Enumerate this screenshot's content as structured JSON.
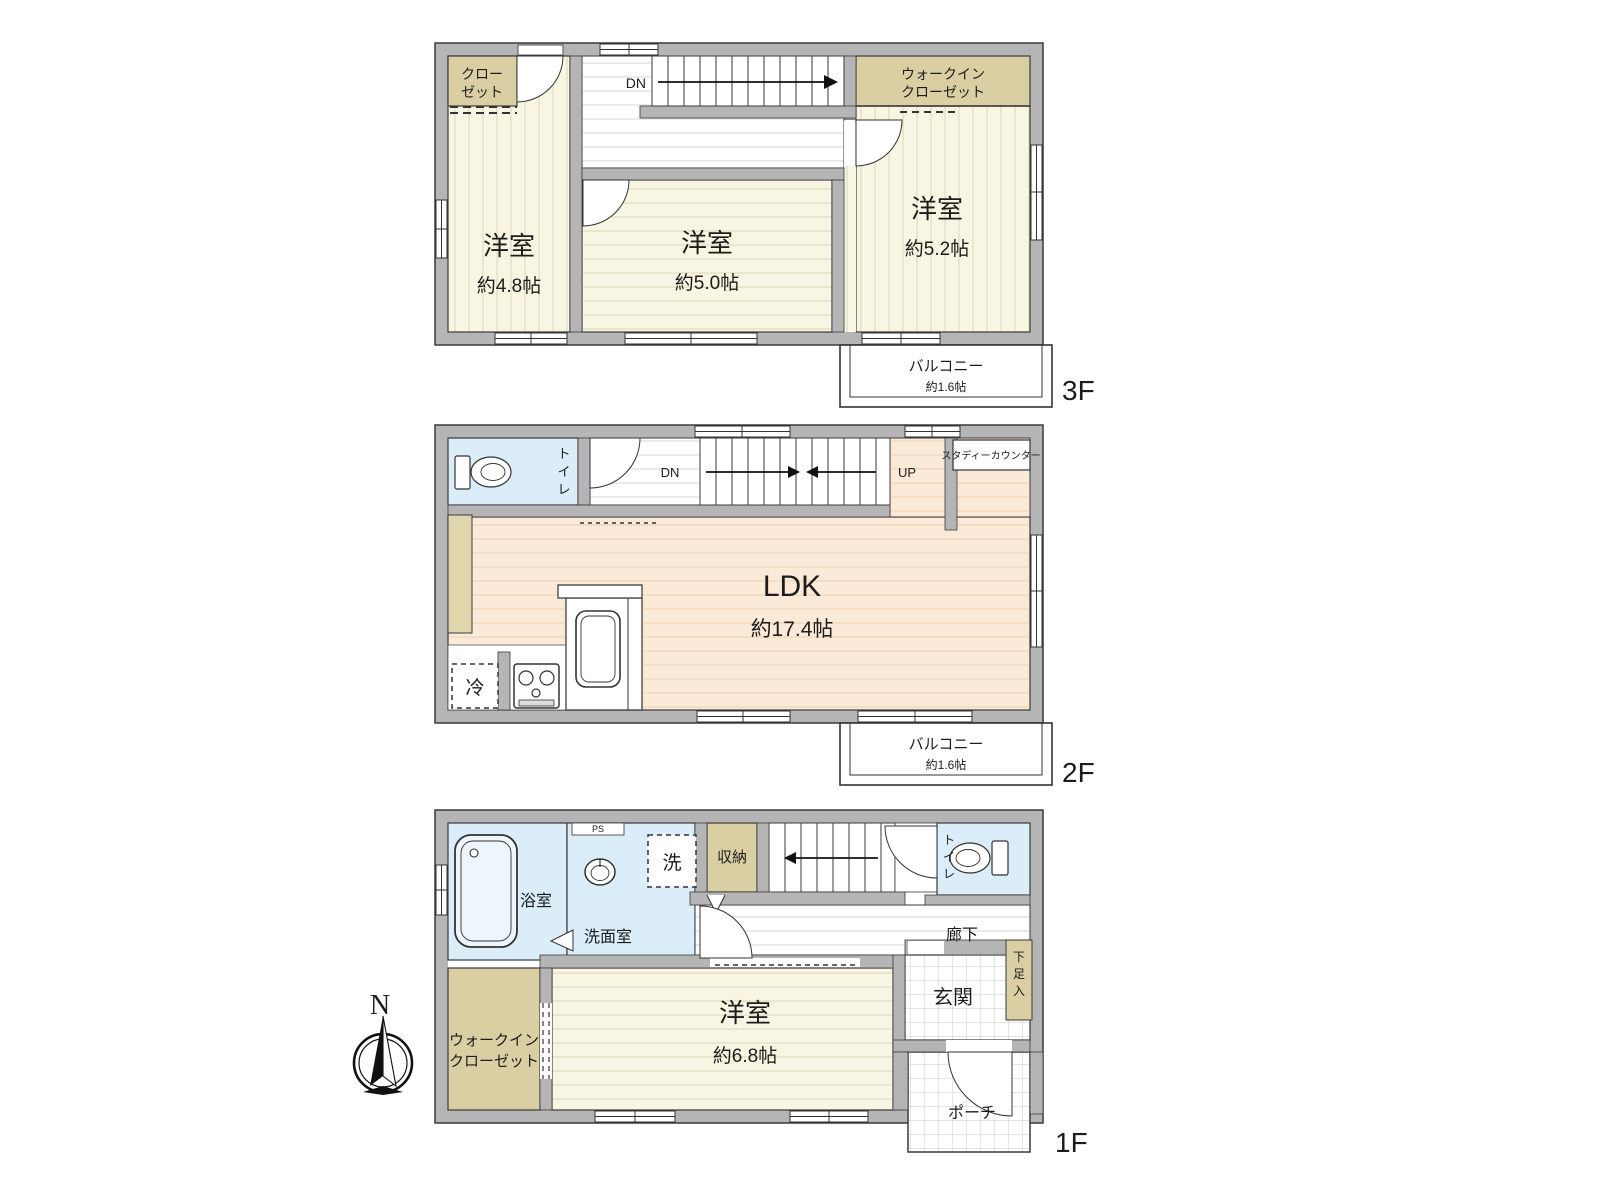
{
  "compass": {
    "north_label": "N"
  },
  "floor3": {
    "floor_label": "3F",
    "closet": {
      "line1": "クロー",
      "line2": "ゼット"
    },
    "bedroom_left": {
      "name": "洋室",
      "size": "約4.8帖"
    },
    "bedroom_center": {
      "name": "洋室",
      "size": "約5.0帖"
    },
    "bedroom_right": {
      "name": "洋室",
      "size": "約5.2帖"
    },
    "wic": {
      "line1": "ウォークイン",
      "line2": "クローゼット"
    },
    "stairs_dn": "DN",
    "balcony": {
      "name": "バルコニー",
      "size": "約1.6帖"
    }
  },
  "floor2": {
    "floor_label": "2F",
    "toilet": [
      "ト",
      "イ",
      "レ"
    ],
    "stairs_dn": "DN",
    "stairs_up": "UP",
    "study_counter": "スタディーカウンター",
    "ldk": {
      "name": "LDK",
      "size": "約17.4帖"
    },
    "fridge": "冷",
    "balcony": {
      "name": "バルコニー",
      "size": "約1.6帖"
    }
  },
  "floor1": {
    "floor_label": "1F",
    "bath": "浴室",
    "ps": "PS",
    "washroom": "洗面室",
    "laundry": "洗",
    "storage": "収納",
    "stairs_up": "UP",
    "toilet": [
      "ト",
      "イ",
      "レ"
    ],
    "corridor": "廊下",
    "wic": {
      "line1": "ウォークイン",
      "line2": "クローゼット"
    },
    "bedroom": {
      "name": "洋室",
      "size": "約6.8帖"
    },
    "entrance": "玄関",
    "shoe_cabinet": [
      "下",
      "足",
      "入"
    ],
    "porch": "ポーチ"
  },
  "colors": {
    "wall": "#b5b5b5",
    "room_cream": "#f8f5e2",
    "room_peach": "#fcead8",
    "room_blue": "#daedf8",
    "closet_beige": "#d9cfa2",
    "line": "#3a3a3a"
  }
}
